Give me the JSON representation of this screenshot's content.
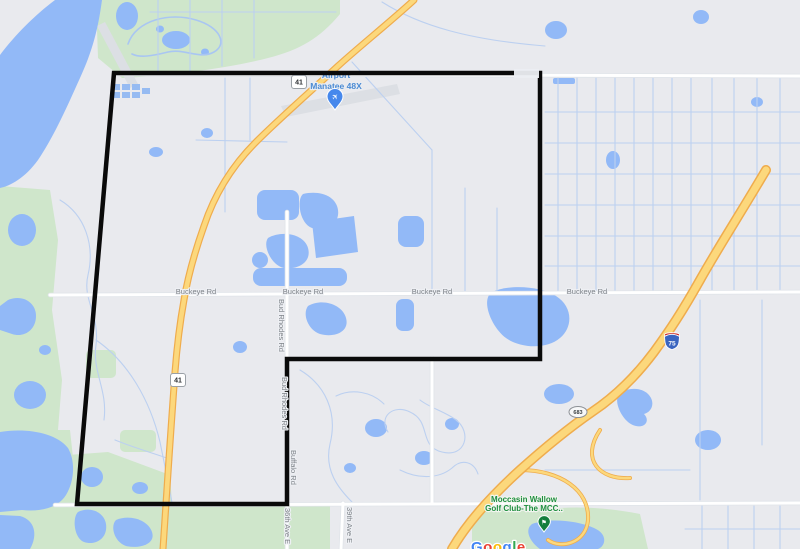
{
  "map": {
    "type": "google-map-with-territory-outline",
    "poi": {
      "airport": {
        "label_line1": "Airport",
        "label_line2": "Manatee 48X"
      },
      "golf_club": {
        "label_line1": "Moccasin Wallow",
        "label_line2": "Golf Club-The MCC.."
      }
    },
    "road_labels": {
      "buckeye_rd": "Buckeye Rd",
      "bud_rhodes_rd": "Bud Rhodes Rd",
      "buffalo_rd": "Buffalo Rd",
      "ave_36": "36th Ave E",
      "ave_39": "39th Ave E"
    },
    "route_shields": {
      "us_41": "41",
      "i_75": "75",
      "fl_683": "683"
    },
    "attribution": {
      "logo_letters": [
        "G",
        "o",
        "o",
        "g",
        "l",
        "e"
      ]
    },
    "colors": {
      "background": "#e9eaee",
      "water": "#92b9f7",
      "park": "#cfe6cb",
      "runway_gray": "#dcdfe4",
      "road_white": "#ffffff",
      "canal_blue": "#bcd0f0",
      "highway_fill": "#fcd87c",
      "highway_casing": "#efac4d",
      "boundary_black": "#0a0a0a",
      "road_label_gray": "#7d8288",
      "airport_label_blue": "#4b8bd4",
      "golf_label_green": "#1e8e3e",
      "interstate_blue": "#3a65c0",
      "interstate_red": "#cb2b26",
      "google_blue": "#4285F4",
      "google_red": "#EA4335",
      "google_yellow": "#FBBC05",
      "google_green": "#34A853"
    }
  }
}
